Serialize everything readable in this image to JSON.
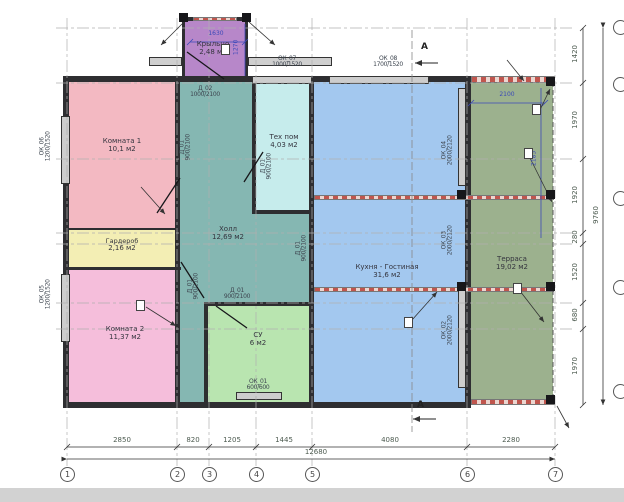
{
  "plan": {
    "rooms": [
      {
        "name": "Крыльцо",
        "area": "2,48 м2",
        "color": "#b787c9"
      },
      {
        "name": "Комната 1",
        "area": "10,1 м2",
        "color": "#f3b9c2"
      },
      {
        "name": "Гардероб",
        "area": "2,16 м2",
        "color": "#f3eeb4"
      },
      {
        "name": "Комната 2",
        "area": "11,37 м2",
        "color": "#f5bedb"
      },
      {
        "name": "Холл",
        "area": "12,69 м2",
        "color": "#85b7b2"
      },
      {
        "name": "Тех пом",
        "area": "4,03 м2",
        "color": "#c6ecec"
      },
      {
        "name": "СУ",
        "area": "6 м2",
        "color": "#b9e5b0"
      },
      {
        "name": "Кухня - Гостиная",
        "area": "31,6 м2",
        "color": "#a3c8ef"
      },
      {
        "name": "Терраса",
        "area": "19,02 м2",
        "color": "#9cb18e"
      }
    ],
    "grid_bubbles": [
      "1",
      "2",
      "3",
      "4",
      "5",
      "6",
      "7"
    ],
    "dims": {
      "bottom": [
        "2850",
        "820",
        "1205",
        "1445",
        "4080",
        "2280"
      ],
      "bottom_total": "12680",
      "right": [
        "1420",
        "1970",
        "1920",
        "280",
        "1520",
        "680",
        "1970"
      ],
      "right_total": "9760",
      "porch_width": "1630",
      "porch_height": "1270",
      "terrace_width": "2100",
      "terrace_height": "2185"
    },
    "openings": [
      {
        "mark": "ОК_07",
        "size": "1000/1520"
      },
      {
        "mark": "ОК_08",
        "size": "1700/1520"
      },
      {
        "mark": "ОК_06",
        "size": "1200/1520"
      },
      {
        "mark": "ОК_05",
        "size": "1200/1520"
      },
      {
        "mark": "ОК_01",
        "size": "600/600"
      },
      {
        "mark": "ОК_04",
        "size": "2000/2120"
      },
      {
        "mark": "ОК_03",
        "size": "2000/2120"
      },
      {
        "mark": "ОК_02",
        "size": "2000/2120"
      }
    ],
    "doors": [
      {
        "mark": "Д_02",
        "size": "1000/2100"
      },
      {
        "mark": "Д_01",
        "size": "900/2100"
      },
      {
        "mark": "Д_01",
        "size": "900/2100"
      },
      {
        "mark": "Д_01",
        "size": "900/2100"
      },
      {
        "mark": "Д_01",
        "size": "900/2100"
      },
      {
        "mark": "Д_01",
        "size": "900/2100"
      }
    ],
    "section_marker": "А"
  }
}
